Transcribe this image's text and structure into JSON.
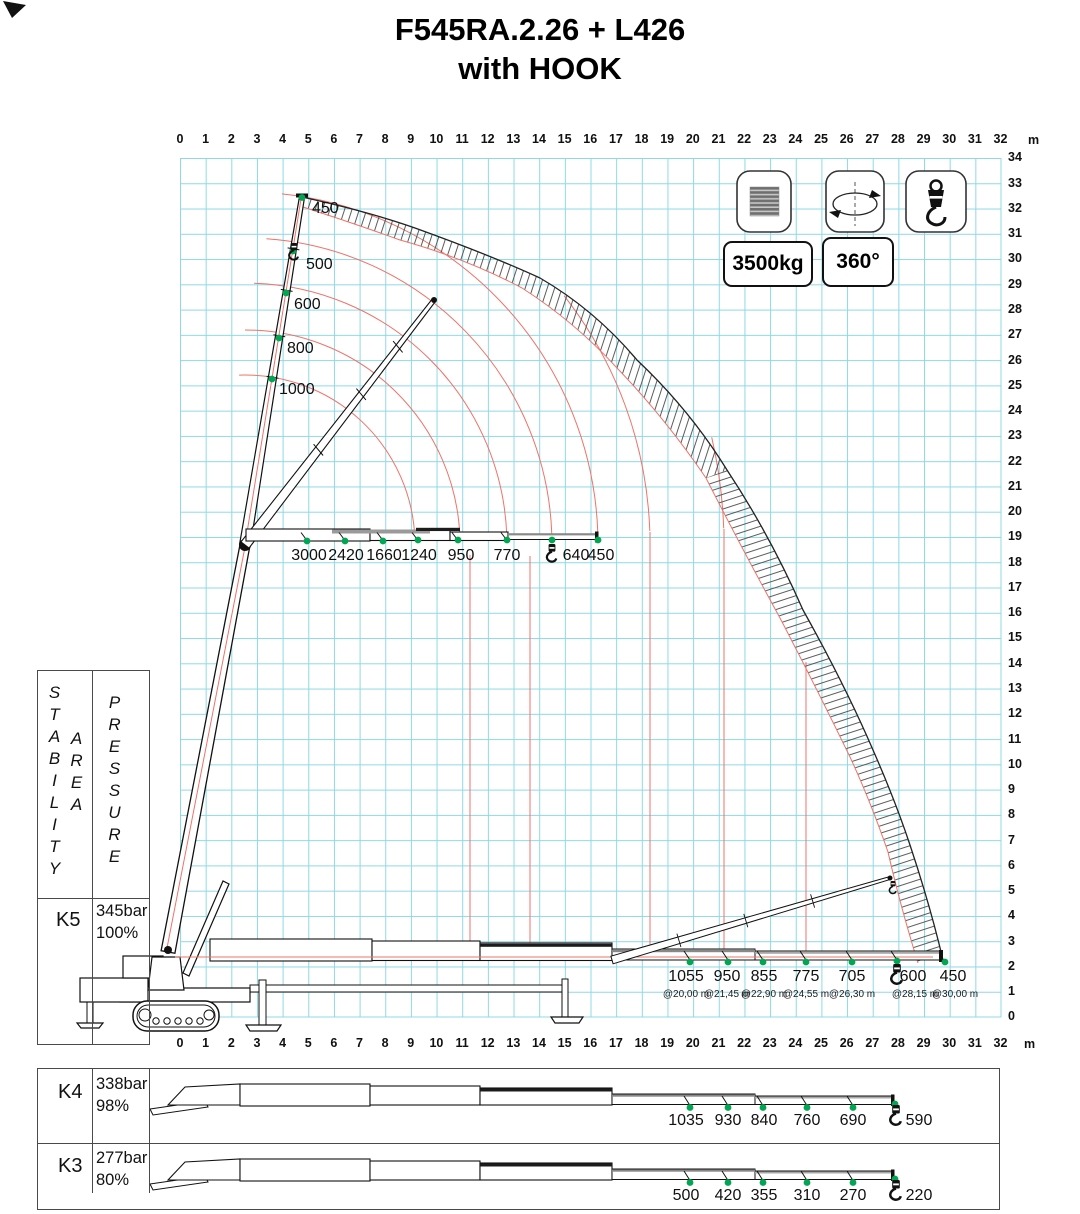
{
  "title": {
    "line1": "F545RA.2.26 + L426",
    "line2": "with HOOK"
  },
  "badges": {
    "capacity": "3500kg",
    "rotation": "360°"
  },
  "axes": {
    "unit": "m",
    "top": [
      "0",
      "1",
      "2",
      "3",
      "4",
      "5",
      "6",
      "7",
      "8",
      "9",
      "10",
      "11",
      "12",
      "13",
      "14",
      "15",
      "16",
      "17",
      "18",
      "19",
      "20",
      "21",
      "22",
      "23",
      "24",
      "25",
      "26",
      "27",
      "28",
      "29",
      "30",
      "31",
      "32"
    ],
    "bottom": [
      "0",
      "1",
      "2",
      "3",
      "4",
      "5",
      "6",
      "7",
      "8",
      "9",
      "10",
      "11",
      "12",
      "13",
      "14",
      "15",
      "16",
      "17",
      "18",
      "19",
      "20",
      "21",
      "22",
      "23",
      "24",
      "25",
      "26",
      "27",
      "28",
      "29",
      "30",
      "31",
      "32"
    ],
    "right": [
      "34",
      "33",
      "32",
      "31",
      "30",
      "29",
      "28",
      "27",
      "26",
      "25",
      "24",
      "23",
      "22",
      "21",
      "20",
      "19",
      "18",
      "17",
      "16",
      "15",
      "14",
      "13",
      "12",
      "11",
      "10",
      "9",
      "8",
      "7",
      "6",
      "5",
      "4",
      "3",
      "2",
      "1",
      "0"
    ]
  },
  "stability_table": {
    "header": {
      "stability": "STABILITY",
      "area": "AREA",
      "pressure": "PRESSURE"
    },
    "rows": [
      {
        "key": "K5",
        "pressure": "345bar",
        "percent": "100%"
      },
      {
        "key": "K4",
        "pressure": "338bar",
        "percent": "98%"
      },
      {
        "key": "K3",
        "pressure": "277bar",
        "percent": "80%"
      }
    ]
  },
  "loads": {
    "mast_vertical": [
      "450",
      "500",
      "600",
      "800",
      "1000"
    ],
    "boom_19m": [
      "3000",
      "2420",
      "1660",
      "1240",
      "950",
      "770",
      "640",
      "450"
    ],
    "ground_k5": {
      "values": [
        "1055",
        "950",
        "855",
        "775",
        "705",
        "600",
        "450"
      ],
      "outreach": [
        "@20,00 m",
        "@21,45 m",
        "@22,90 m",
        "@24,55 m",
        "@26,30 m",
        "@28,15 m",
        "@30,00 m"
      ]
    },
    "k4": [
      "1035",
      "930",
      "840",
      "760",
      "690",
      "590"
    ],
    "k3": [
      "500",
      "420",
      "355",
      "310",
      "270",
      "220"
    ]
  },
  "chart_data": {
    "type": "table",
    "title": "F545RA.2.26 + L426 with HOOK load diagram",
    "max_capacity_kg": 3500,
    "slewing": "360°",
    "x_axis_range_m": [
      0,
      32
    ],
    "y_axis_range_m": [
      0,
      34
    ],
    "series": [
      {
        "name": "mast near-vertical loads (kg)",
        "values": [
          450,
          500,
          600,
          800,
          1000
        ]
      },
      {
        "name": "horizontal boom at ~19 m height (kg)",
        "values": [
          3000,
          2420,
          1660,
          1240,
          950,
          770,
          640,
          450
        ]
      },
      {
        "name": "K5 ground level 100% / 345bar (kg)",
        "values": [
          1055,
          950,
          855,
          775,
          705,
          600,
          450
        ],
        "outreach_m": [
          20.0,
          21.45,
          22.9,
          24.55,
          26.3,
          28.15,
          30.0
        ]
      },
      {
        "name": "K4 98% / 338bar (kg)",
        "values": [
          1035,
          930,
          840,
          760,
          690,
          590
        ]
      },
      {
        "name": "K3 80% / 277bar (kg)",
        "values": [
          500,
          420,
          355,
          310,
          270,
          220
        ]
      }
    ],
    "colors": {
      "grid": "#8fd8e6",
      "arcs": "#ee7368",
      "load_points": "#00a651"
    }
  }
}
